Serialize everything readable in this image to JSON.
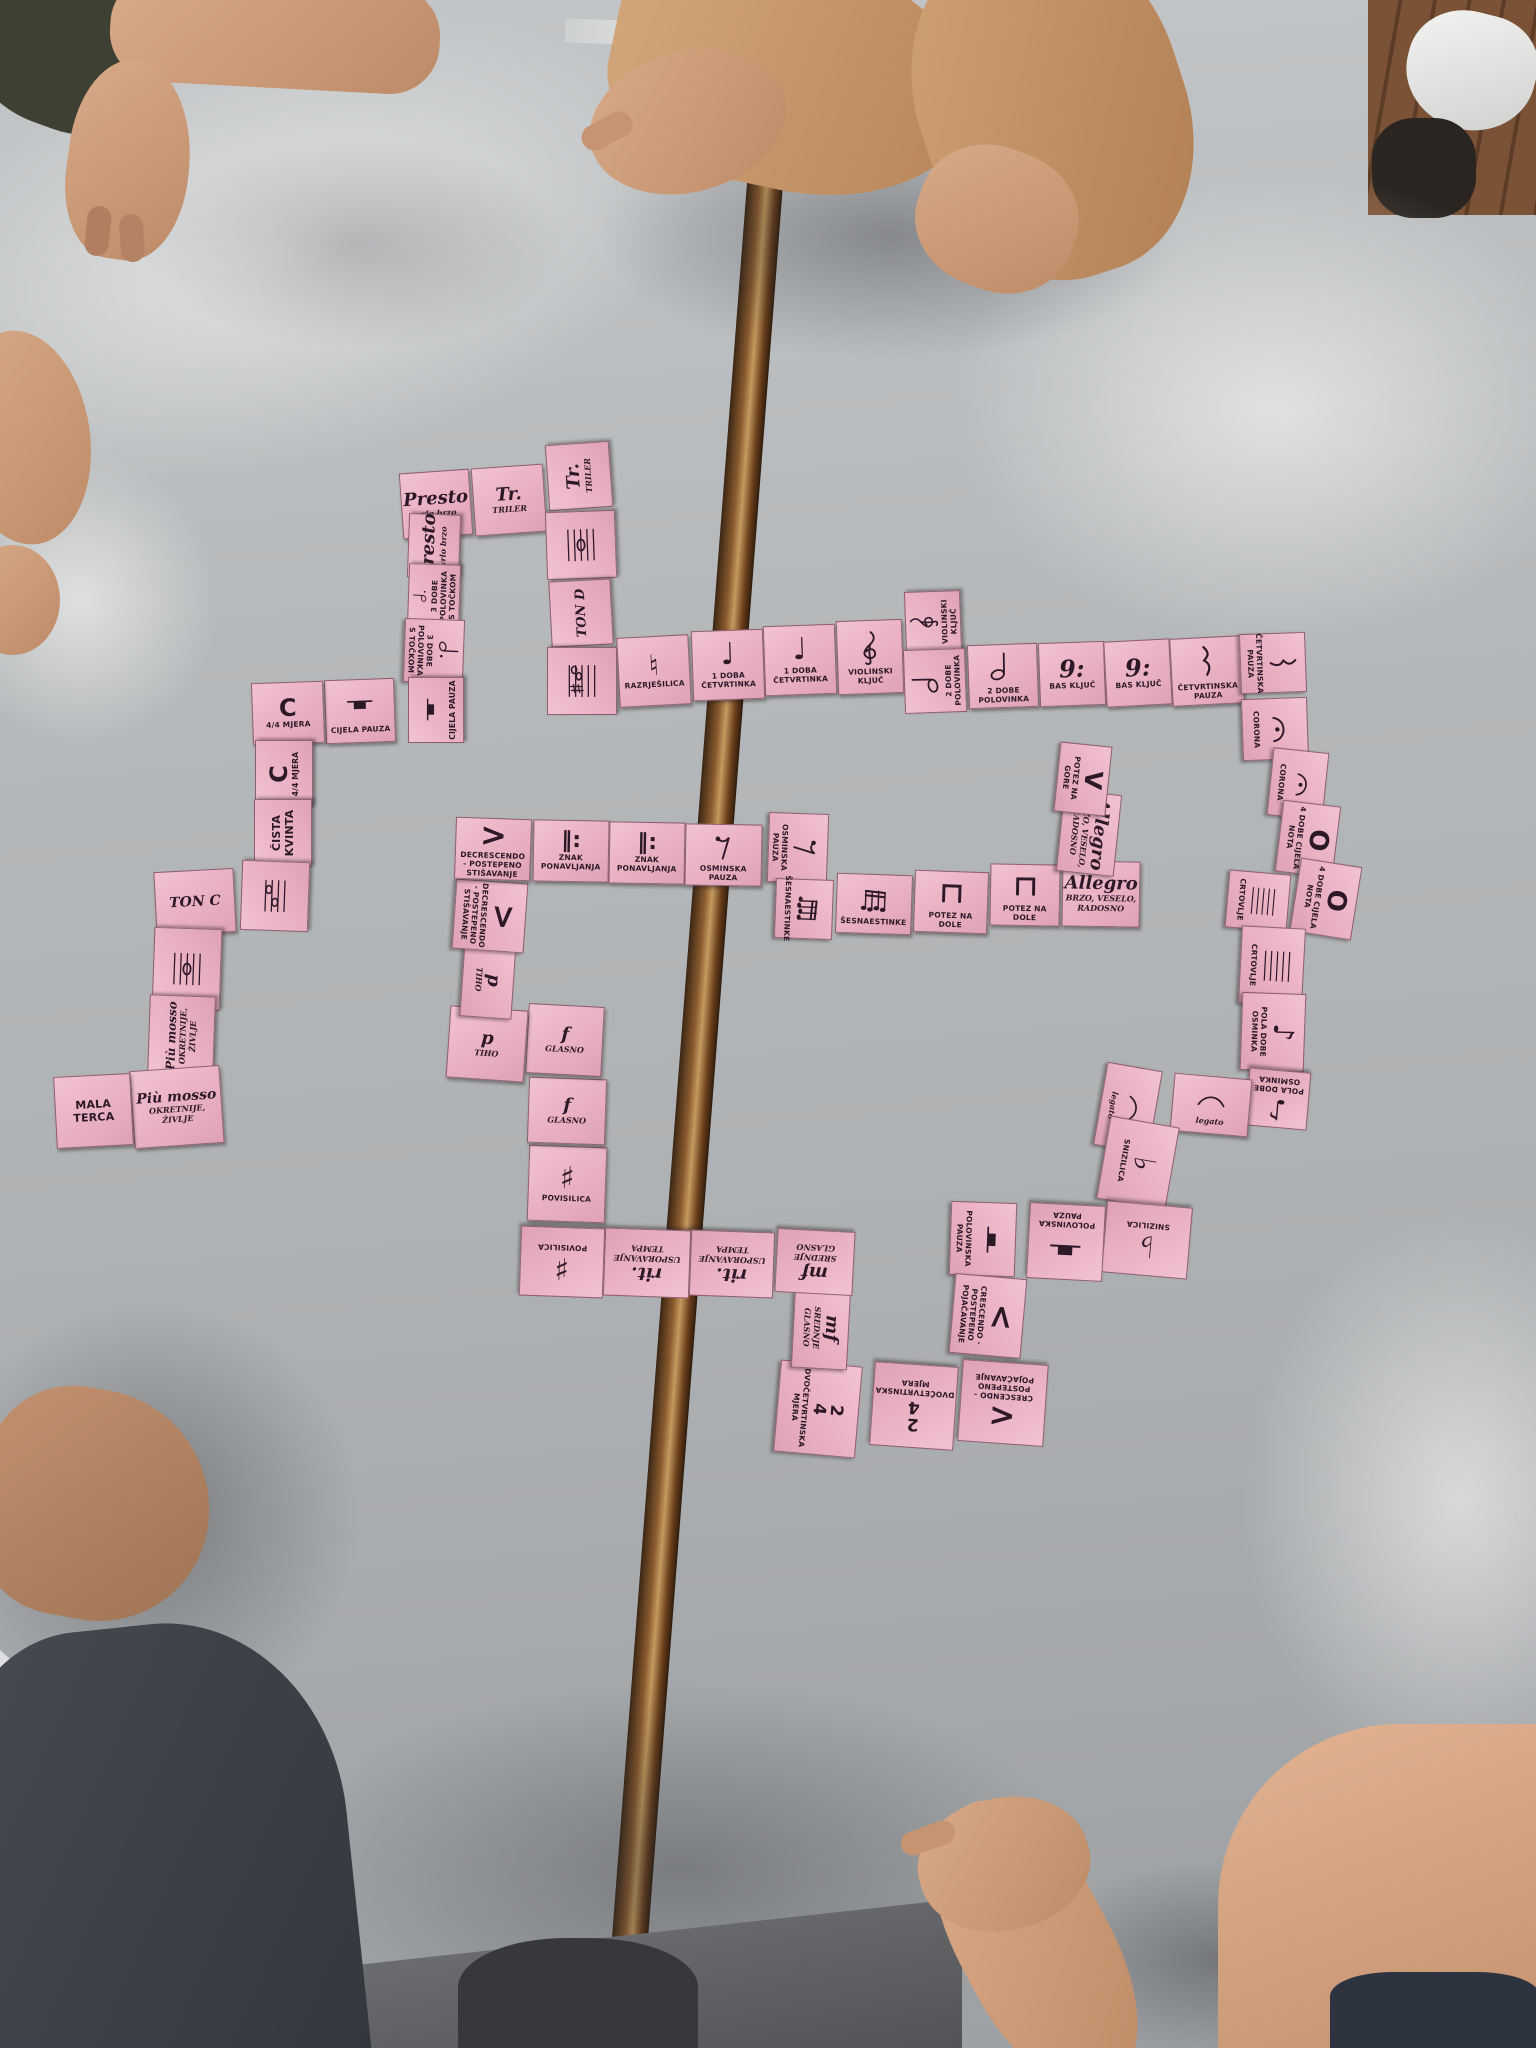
{
  "scene": {
    "colors": {
      "card_pink": "#edb6c6",
      "ink": "#2c1826",
      "table_gray": "#b6b9bb",
      "wood_gap": "#8a5a2e",
      "floor_wood": "#8a5f42",
      "sweater_tan": "#c08a5f",
      "skin": "#d9ab89",
      "jeans_dark": "#3e4248"
    }
  },
  "symbols": {
    "quarter-note": {
      "kind": "text",
      "glyph": "♩",
      "size": 30
    },
    "eighth-note": {
      "kind": "text",
      "glyph": "♪",
      "size": 28
    },
    "sharp": {
      "kind": "text",
      "glyph": "♯",
      "size": 30
    },
    "flat": {
      "kind": "text",
      "glyph": "♭",
      "size": 30
    },
    "natural": {
      "kind": "text",
      "glyph": "♮",
      "size": 28
    },
    "common-time": {
      "kind": "text",
      "glyph": "C",
      "size": 24
    },
    "whole-note": {
      "kind": "text",
      "glyph": "O",
      "size": 26
    },
    "crescendo": {
      "kind": "text",
      "glyph": "<",
      "size": 32
    },
    "decrescendo": {
      "kind": "text",
      "glyph": ">",
      "size": 32
    },
    "up-bow": {
      "kind": "text",
      "glyph": "V",
      "size": 24
    },
    "repeat": {
      "kind": "text",
      "glyph": "‖:",
      "size": 22
    },
    "bass-clef": {
      "kind": "text",
      "glyph": "9:",
      "size": 24,
      "italic": true
    },
    "two-four": {
      "kind": "frac",
      "top": "2",
      "bottom": "4"
    },
    "treble-clef": {
      "kind": "svg",
      "ref": "treble"
    },
    "half-note": {
      "kind": "svg",
      "ref": "halfnote"
    },
    "dotted-half": {
      "kind": "svg",
      "ref": "dottedhalf"
    },
    "quarter-rest": {
      "kind": "svg",
      "ref": "qrest"
    },
    "eighth-rest": {
      "kind": "svg",
      "ref": "erest"
    },
    "half-rest": {
      "kind": "svg",
      "ref": "hrest"
    },
    "whole-rest": {
      "kind": "svg",
      "ref": "wrest"
    },
    "fermata": {
      "kind": "svg",
      "ref": "fermata"
    },
    "slur": {
      "kind": "svg",
      "ref": "slur"
    },
    "down-bow": {
      "kind": "svg",
      "ref": "downbow"
    },
    "sixteenths": {
      "kind": "svg",
      "ref": "sixteenths"
    },
    "staff": {
      "kind": "svg",
      "ref": "staff"
    },
    "whole-note-staff": {
      "kind": "svg",
      "ref": "wnstaff"
    },
    "sharps-staff": {
      "kind": "svg",
      "ref": "sharpsstaff"
    },
    "interval": {
      "kind": "svg",
      "ref": "interval"
    }
  },
  "cards": [
    {
      "id": "presto-1",
      "x": 401,
      "y": 471,
      "w": 70,
      "h": 66,
      "rot": -4,
      "text": "Presto",
      "sub": "vrlo brzo"
    },
    {
      "id": "triler-1",
      "x": 473,
      "y": 466,
      "w": 72,
      "h": 68,
      "rot": -4,
      "text": "Tr.",
      "sub": "TRILER"
    },
    {
      "id": "triler-2",
      "x": 546,
      "y": 444,
      "w": 66,
      "h": 64,
      "rot": -94,
      "text": "Tr.",
      "sub": "TRILER"
    },
    {
      "id": "nota-na-crtovlju-1",
      "x": 547,
      "y": 510,
      "w": 68,
      "h": 70,
      "rot": -92,
      "sym": "whole-note-staff"
    },
    {
      "id": "ton-d",
      "x": 548,
      "y": 582,
      "w": 66,
      "h": 62,
      "rot": -93,
      "text": "TON D",
      "fs": 13
    },
    {
      "id": "predznaci",
      "x": 548,
      "y": 646,
      "w": 68,
      "h": 70,
      "rot": -90,
      "sym": "sharps-staff"
    },
    {
      "id": "razrjesilica",
      "x": 618,
      "y": 636,
      "w": 72,
      "h": 70,
      "rot": -3,
      "sym": "natural",
      "label": "RAZRJEŠILICA"
    },
    {
      "id": "cetvrtinka-1",
      "x": 692,
      "y": 630,
      "w": 72,
      "h": 70,
      "rot": -2,
      "sym": "quarter-note",
      "label": "1 DOBA ČETVRTINKA"
    },
    {
      "id": "cetvrtinka-2",
      "x": 764,
      "y": 625,
      "w": 72,
      "h": 70,
      "rot": -2,
      "sym": "quarter-note",
      "label": "1 DOBA ČETVRTINKA"
    },
    {
      "id": "violinski-kljuc-1",
      "x": 837,
      "y": 620,
      "w": 66,
      "h": 74,
      "rot": -2,
      "sym": "treble-clef",
      "label": "VIOLINSKI KLJUČ"
    },
    {
      "id": "violinski-kljuc-2",
      "x": 902,
      "y": 594,
      "w": 62,
      "h": 56,
      "rot": -92,
      "sym": "treble-clef",
      "label": "VIOLINSKI KLJUČ"
    },
    {
      "id": "polovinka-1",
      "x": 903,
      "y": 650,
      "w": 64,
      "h": 62,
      "rot": -92,
      "sym": "half-note",
      "label": "2 DOBE POLOVINKA"
    },
    {
      "id": "polovinka-2",
      "x": 968,
      "y": 644,
      "w": 70,
      "h": 64,
      "rot": -2,
      "sym": "half-note",
      "label": "2 DOBE POLOVINKA"
    },
    {
      "id": "bas-kljuc-1",
      "x": 1039,
      "y": 642,
      "w": 66,
      "h": 64,
      "rot": -2,
      "sym": "bass-clef",
      "label": "BAS KLJUČ"
    },
    {
      "id": "bas-kljuc-2",
      "x": 1105,
      "y": 640,
      "w": 66,
      "h": 66,
      "rot": -3,
      "sym": "bass-clef",
      "label": "BAS KLJUČ"
    },
    {
      "id": "cetvrtinska-pauza-1",
      "x": 1171,
      "y": 637,
      "w": 72,
      "h": 68,
      "rot": -3,
      "sym": "quarter-rest",
      "label": "ČETVRTINSKA PAUZA"
    },
    {
      "id": "cetvrtinska-pauza-2",
      "x": 1243,
      "y": 630,
      "w": 60,
      "h": 66,
      "rot": 88,
      "sym": "quarter-rest",
      "label": "ČETVRTINSKA PAUZA"
    },
    {
      "id": "corona-1",
      "x": 1244,
      "y": 696,
      "w": 62,
      "h": 66,
      "rot": 88,
      "sym": "fermata",
      "label": "CORONA"
    },
    {
      "id": "corona-2",
      "x": 1264,
      "y": 756,
      "w": 68,
      "h": 56,
      "rot": 96,
      "sym": "fermata",
      "label": "CORONA"
    },
    {
      "id": "cijela-nota-1",
      "x": 1272,
      "y": 810,
      "w": 72,
      "h": 58,
      "rot": 97,
      "sym": "whole-note",
      "label": "4 DOBE CIJELA NOTA"
    },
    {
      "id": "cijela-nota-2",
      "x": 1289,
      "y": 868,
      "w": 74,
      "h": 62,
      "rot": 99,
      "sym": "whole-note",
      "label": "4 DOBE CIJELA NOTA"
    },
    {
      "id": "crtovlje-1",
      "x": 1229,
      "y": 870,
      "w": 58,
      "h": 62,
      "rot": 95,
      "sym": "staff",
      "label": "CRTOVLJE"
    },
    {
      "id": "crtovlje-2",
      "x": 1233,
      "y": 934,
      "w": 78,
      "h": 64,
      "rot": 93,
      "sym": "staff",
      "label": "CRTOVLJE"
    },
    {
      "id": "osminka-1",
      "x": 1234,
      "y": 1000,
      "w": 78,
      "h": 64,
      "rot": 92,
      "sym": "eighth-note",
      "label": "POLA DOBE OSMINKA"
    },
    {
      "id": "osminka-2",
      "x": 1247,
      "y": 1070,
      "w": 62,
      "h": 58,
      "rot": 185,
      "sym": "eighth-note",
      "label": "POLA DOBE OSMINKA"
    },
    {
      "id": "legato-1",
      "x": 1172,
      "y": 1076,
      "w": 78,
      "h": 58,
      "rot": 5,
      "sym": "slur",
      "sub": "legato"
    },
    {
      "id": "legato-2",
      "x": 1086,
      "y": 1080,
      "w": 84,
      "h": 56,
      "rot": 100,
      "sym": "slur",
      "sub": "legato"
    },
    {
      "id": "snizilica-1",
      "x": 1096,
      "y": 1128,
      "w": 84,
      "h": 70,
      "rot": 100,
      "sym": "flat",
      "label": "SNIZILICA"
    },
    {
      "id": "snizilica-2",
      "x": 1104,
      "y": 1204,
      "w": 86,
      "h": 72,
      "rot": 185,
      "sym": "flat",
      "label": "SNIZILICA"
    },
    {
      "id": "polovinska-pauza-1",
      "x": 1028,
      "y": 1204,
      "w": 76,
      "h": 76,
      "rot": 183,
      "sym": "half-rest",
      "label": "POLOVINSKA PAUZA"
    },
    {
      "id": "polovinska-pauza-2",
      "x": 946,
      "y": 1206,
      "w": 74,
      "h": 66,
      "rot": 92,
      "sym": "half-rest",
      "label": "POLOVINSKA PAUZA"
    },
    {
      "id": "crescendo-1",
      "x": 948,
      "y": 1280,
      "w": 80,
      "h": 72,
      "rot": 95,
      "sym": "crescendo",
      "label": "CRESCENDO - POSTEPENO POJAČAVANJE"
    },
    {
      "id": "crescendo-2",
      "x": 960,
      "y": 1362,
      "w": 86,
      "h": 82,
      "rot": 184,
      "sym": "crescendo",
      "label": "CRESCENDO - POSTEPENO POJAČAVANJE"
    },
    {
      "id": "dvocetvrtinska-mjera-1",
      "x": 872,
      "y": 1364,
      "w": 84,
      "h": 84,
      "rot": 184,
      "sym": "two-four",
      "label": "DVOČETVRTINSKA MJERA"
    },
    {
      "id": "dvocetvrtinska-mjera-2",
      "x": 772,
      "y": 1368,
      "w": 92,
      "h": 82,
      "rot": 95,
      "sym": "two-four",
      "label": "DVOČETVRTINSKA MJERA"
    },
    {
      "id": "mf-1",
      "x": 780,
      "y": 1300,
      "w": 82,
      "h": 56,
      "rot": 93,
      "text": "mf",
      "sub": "SREDNJE GLASNO"
    },
    {
      "id": "mf-2",
      "x": 776,
      "y": 1230,
      "w": 78,
      "h": 64,
      "rot": 183,
      "text": "mf",
      "sub": "SREDNJE GLASNO"
    },
    {
      "id": "rit-1",
      "x": 690,
      "y": 1231,
      "w": 84,
      "h": 66,
      "rot": 182,
      "text": "rit.",
      "sub": "USPORAVANJE TEMPA"
    },
    {
      "id": "rit-2",
      "x": 604,
      "y": 1229,
      "w": 86,
      "h": 68,
      "rot": 182,
      "text": "rit.",
      "sub": "USPORAVANJE TEMPA"
    },
    {
      "id": "povisilica-1",
      "x": 520,
      "y": 1227,
      "w": 84,
      "h": 70,
      "rot": 182,
      "sym": "sharp",
      "label": "POVISILICA"
    },
    {
      "id": "povisilica-2",
      "x": 528,
      "y": 1146,
      "w": 78,
      "h": 76,
      "rot": 2,
      "sym": "sharp",
      "label": "POVISILICA"
    },
    {
      "id": "glasno-1",
      "x": 528,
      "y": 1078,
      "w": 78,
      "h": 66,
      "rot": 2,
      "text": "f",
      "sub": "GLASNO"
    },
    {
      "id": "glasno-2",
      "x": 527,
      "y": 1005,
      "w": 76,
      "h": 70,
      "rot": 3,
      "text": "f",
      "sub": "GLASNO"
    },
    {
      "id": "tiho-1",
      "x": 448,
      "y": 1008,
      "w": 78,
      "h": 72,
      "rot": 4,
      "text": "p",
      "sub": "TIHO"
    },
    {
      "id": "tiho-2",
      "x": 450,
      "y": 954,
      "w": 76,
      "h": 52,
      "rot": 94,
      "text": "p",
      "sub": "TIHO"
    },
    {
      "id": "decrescendo-1",
      "x": 455,
      "y": 880,
      "w": 70,
      "h": 72,
      "rot": 94,
      "sym": "decrescendo",
      "label": "DECRESCENDO - POSTEPENO STIŠAVANJE"
    },
    {
      "id": "decrescendo-2",
      "x": 455,
      "y": 818,
      "w": 76,
      "h": 62,
      "rot": 2,
      "sym": "decrescendo",
      "label": "DECRESCENDO - POSTEPENO STIŠAVANJE"
    },
    {
      "id": "znak-ponavljanja-1",
      "x": 533,
      "y": 820,
      "w": 76,
      "h": 62,
      "rot": 1,
      "sym": "repeat",
      "label": "ZNAK PONAVLJANJA"
    },
    {
      "id": "znak-ponavljanja-2",
      "x": 609,
      "y": 822,
      "w": 76,
      "h": 62,
      "rot": 1,
      "sym": "repeat",
      "label": "ZNAK PONAVLJANJA"
    },
    {
      "id": "osminska-pauza-1",
      "x": 685,
      "y": 824,
      "w": 77,
      "h": 62,
      "rot": 1,
      "sym": "eighth-rest",
      "label": "OSMINSKA PAUZA"
    },
    {
      "id": "osminska-pauza-2",
      "x": 763,
      "y": 818,
      "w": 70,
      "h": 60,
      "rot": 92,
      "sym": "eighth-rest",
      "label": "OSMINSKA PAUZA"
    },
    {
      "id": "sesnaestinke-1",
      "x": 774,
      "y": 880,
      "w": 60,
      "h": 58,
      "rot": 92,
      "sym": "sixteenths",
      "label": "ŠESNAESTINKE"
    },
    {
      "id": "sesnaestinke-2",
      "x": 836,
      "y": 874,
      "w": 76,
      "h": 60,
      "rot": 2,
      "sym": "sixteenths",
      "label": "ŠESNAESTINKE"
    },
    {
      "id": "potez-na-dole-1",
      "x": 914,
      "y": 871,
      "w": 74,
      "h": 62,
      "rot": 2,
      "sym": "down-bow",
      "label": "POTEZ NA DOLE"
    },
    {
      "id": "potez-na-dole-2",
      "x": 990,
      "y": 864,
      "w": 70,
      "h": 62,
      "rot": 1,
      "sym": "down-bow",
      "label": "POTEZ NA DOLE"
    },
    {
      "id": "allegro-1",
      "x": 1062,
      "y": 861,
      "w": 78,
      "h": 66,
      "rot": 1,
      "text": "Allegro",
      "sub": "BRZO, VESELO, RADOSNO"
    },
    {
      "id": "allegro-2",
      "x": 1048,
      "y": 804,
      "w": 82,
      "h": 58,
      "rot": 96,
      "text": "Allegro",
      "sub": "BRZO, VESELO, RADOSNO"
    },
    {
      "id": "potez-na-gore",
      "x": 1048,
      "y": 753,
      "w": 70,
      "h": 52,
      "rot": 96,
      "sym": "up-bow",
      "label": "POTEZ NA GORE"
    },
    {
      "id": "presto-2",
      "x": 402,
      "y": 520,
      "w": 64,
      "h": 52,
      "rot": -88,
      "text": "Presto",
      "sub": "vrlo brzo"
    },
    {
      "id": "polovinka-s-tockom-1",
      "x": 402,
      "y": 570,
      "w": 64,
      "h": 52,
      "rot": -88,
      "sym": "dotted-half",
      "label": "3 DOBE POLOVINKA S TOČKOM"
    },
    {
      "id": "polovinka-s-tockom-2",
      "x": 402,
      "y": 621,
      "w": 64,
      "h": 60,
      "rot": 92,
      "sym": "dotted-half",
      "label": "3 DOBE POLOVINKA S TOČKOM"
    },
    {
      "id": "cijela-pauza-1",
      "x": 403,
      "y": 682,
      "w": 66,
      "h": 56,
      "rot": -90,
      "sym": "whole-rest",
      "label": "CIJELA PAUZA"
    },
    {
      "id": "cijela-pauza-2",
      "x": 325,
      "y": 679,
      "w": 70,
      "h": 64,
      "rot": -2,
      "sym": "whole-rest",
      "label": "CIJELA PAUZA"
    },
    {
      "id": "mjera-44-1",
      "x": 252,
      "y": 682,
      "w": 72,
      "h": 62,
      "rot": -2,
      "sym": "common-time",
      "label": "4/4 MJERA"
    },
    {
      "id": "mjera-44-2",
      "x": 250,
      "y": 745,
      "w": 68,
      "h": 58,
      "rot": -90,
      "sym": "common-time",
      "label": "4/4 MJERA"
    },
    {
      "id": "cista-kvinta",
      "x": 249,
      "y": 804,
      "w": 68,
      "h": 58,
      "rot": -90,
      "label": "ČISTA KVINTA",
      "big": true
    },
    {
      "id": "interval-note",
      "x": 240,
      "y": 862,
      "w": 70,
      "h": 68,
      "rot": -88,
      "sym": "interval"
    },
    {
      "id": "ton-c",
      "x": 155,
      "y": 870,
      "w": 80,
      "h": 64,
      "rot": -3,
      "text": "TON C",
      "fs": 14
    },
    {
      "id": "nota-na-crtovlju-2",
      "x": 146,
      "y": 935,
      "w": 82,
      "h": 68,
      "rot": -88,
      "sym": "whole-note-staff"
    },
    {
      "id": "piu-mosso-1",
      "x": 141,
      "y": 1003,
      "w": 81,
      "h": 66,
      "rot": -88,
      "text": "Più mosso",
      "fs": 12,
      "sub": "OKRETNIJE, ŽIVLJE"
    },
    {
      "id": "piu-mosso-2",
      "x": 132,
      "y": 1068,
      "w": 90,
      "h": 78,
      "rot": -4,
      "text": "Più mosso",
      "fs": 14,
      "sub": "OKRETNIJE, ŽIVLJE"
    },
    {
      "id": "mala-terca",
      "x": 55,
      "y": 1075,
      "w": 77,
      "h": 72,
      "rot": -3,
      "label": "MALA TERCA",
      "big": true
    }
  ]
}
